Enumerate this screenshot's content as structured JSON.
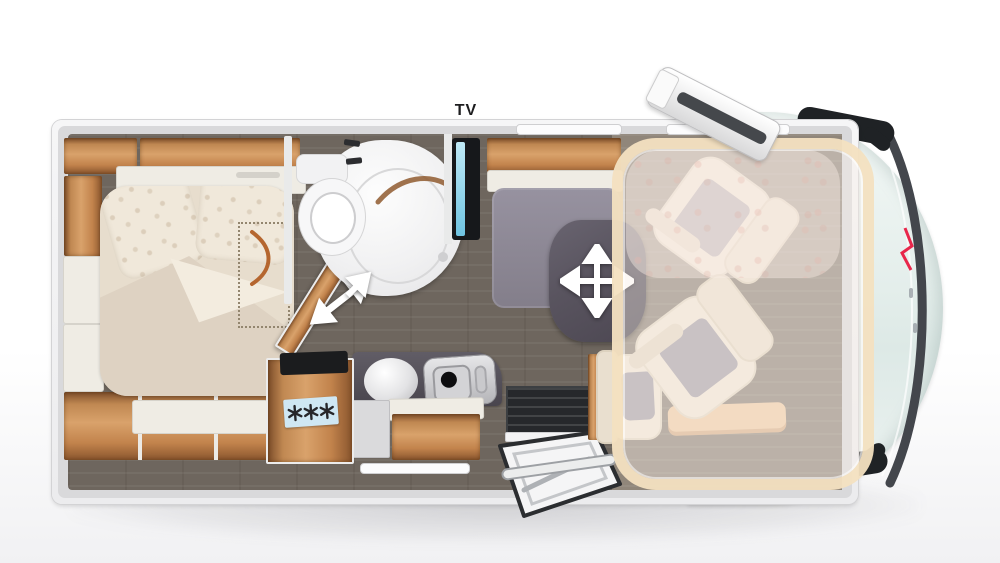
{
  "labels": {
    "tv": "TV"
  },
  "icons": {
    "table_move": "move-crosshair-icon",
    "fridge": "snowflake-icons",
    "sliding_door": "diagonal-double-arrow-icon",
    "bathroom_door": "northeast-arrow-icon"
  },
  "colors": {
    "wood": "#c08852",
    "floor_dark": "#6e665e",
    "counter_dark": "#55515a",
    "table_dark": "#59545f",
    "bench_gray": "#8f8b94",
    "bed_cream": "#e7ddcd",
    "seat_cream": "#f1e7d7",
    "seat_inset_gray": "#a8a3ab",
    "cab_mint": "#e9f1ef",
    "dropdown_bed_frame": "#f2dec0",
    "tv_screen_blue": "#a8dff2",
    "fridge_label_blue": "#cfe7f3",
    "logo_red": "#e8274b",
    "step_dark": "#26282b"
  }
}
